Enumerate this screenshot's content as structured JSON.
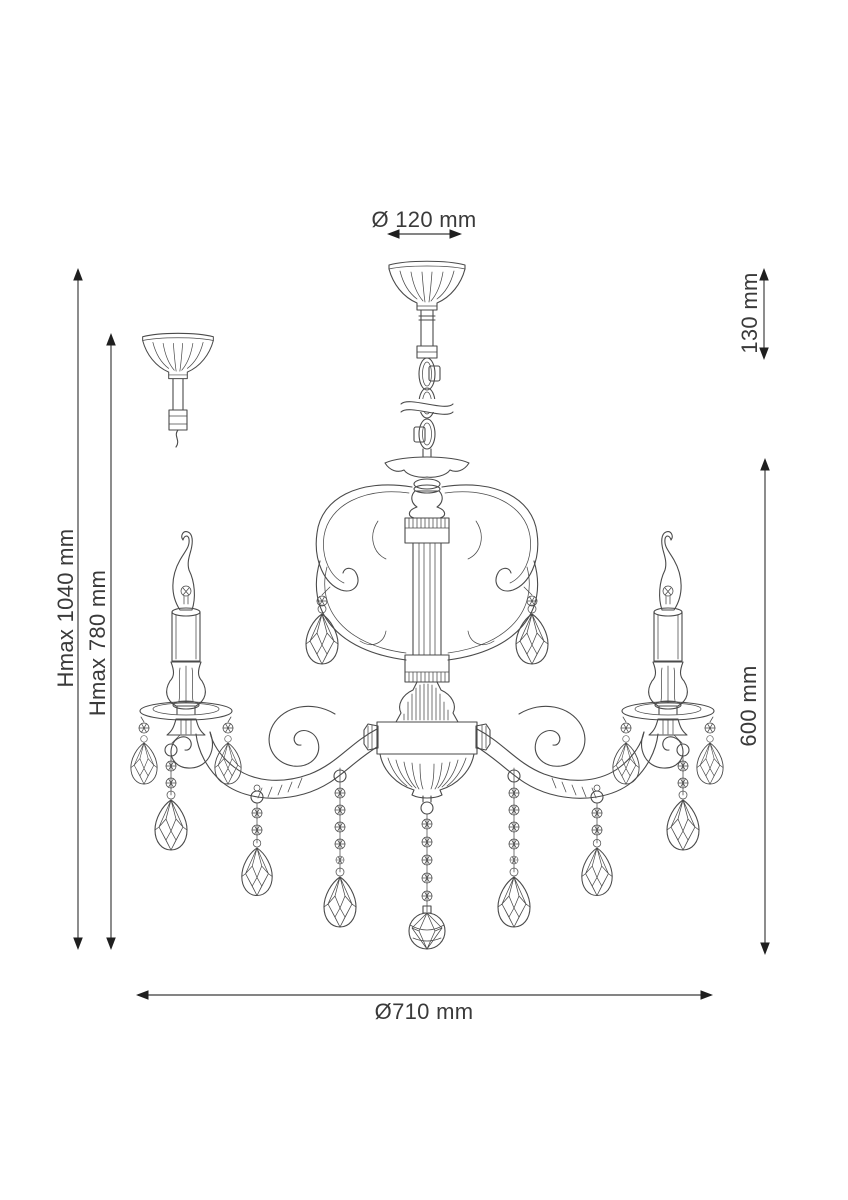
{
  "page": {
    "background_color": "#ffffff"
  },
  "drawing": {
    "line_color": "#4a4a4a",
    "dimension_line_color": "#5c5c5c",
    "arrowhead_color": "#1f1f1f",
    "text_color": "#3a3a3a"
  },
  "dimensions": {
    "canopy_diameter": {
      "label": "Ø 120 mm",
      "orientation": "horizontal"
    },
    "suspension_height": {
      "label": "130 mm",
      "orientation": "vertical"
    },
    "max_height": {
      "label": "Hmax 1040 mm",
      "orientation": "vertical"
    },
    "mid_height": {
      "label": "Hmax 780 mm",
      "orientation": "vertical"
    },
    "body_height": {
      "label": "600 mm",
      "orientation": "vertical"
    },
    "fixture_diameter": {
      "label": "Ø710 mm",
      "orientation": "horizontal"
    }
  }
}
